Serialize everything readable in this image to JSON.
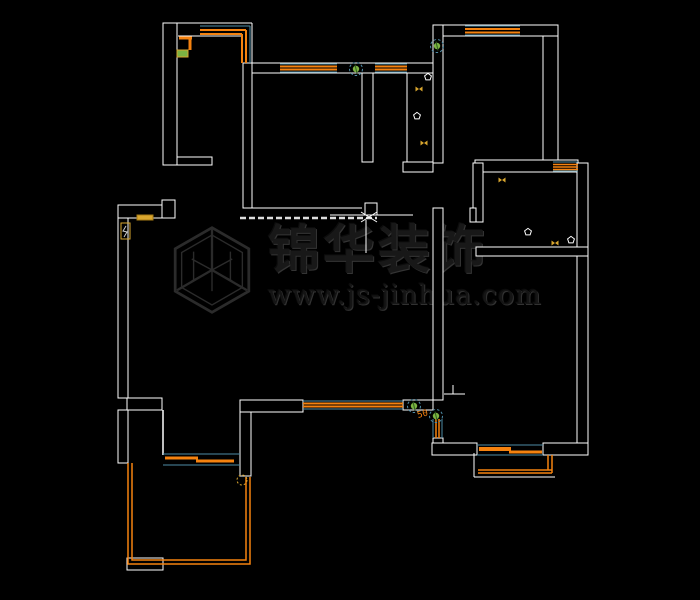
{
  "canvas": {
    "width": 700,
    "height": 600,
    "background": "#000000"
  },
  "watermark": {
    "brand": "锦华装饰",
    "url": "www.js-jinhua.com",
    "logo": "hexagon-cube-icon",
    "color": "#2d2d2d"
  },
  "colors": {
    "wall": "#ffffff",
    "teal": "#4e8ca6",
    "orange": "#f5820f",
    "green": "#7cb342",
    "green_dark": "#2e5d1d",
    "yellow": "#d9a62e",
    "dash_white": "#dddddd",
    "black": "#000000"
  },
  "labels": {
    "dim_50": "50"
  },
  "floorplan": {
    "elements": [
      {
        "t": "rect",
        "n": "wall-band",
        "x": 163,
        "y": 23,
        "w": 14,
        "h": 142,
        "s": "wall",
        "f": "black"
      },
      {
        "t": "rect",
        "n": "wall-band",
        "x": 177,
        "y": 157,
        "w": 35,
        "h": 8,
        "s": "wall",
        "f": "black"
      },
      {
        "t": "rect",
        "n": "wall-band",
        "x": 243,
        "y": 63,
        "w": 9,
        "h": 145,
        "s": "wall",
        "f": "black"
      },
      {
        "t": "rect",
        "n": "wall-band",
        "x": 252,
        "y": 63,
        "w": 181,
        "h": 10,
        "s": "wall",
        "f": "black"
      },
      {
        "t": "rect",
        "n": "wall-band",
        "x": 362,
        "y": 73,
        "w": 11,
        "h": 89,
        "s": "wall",
        "f": "black"
      },
      {
        "t": "rect",
        "n": "wall-band",
        "x": 403,
        "y": 162,
        "w": 30,
        "h": 10,
        "s": "wall",
        "f": "black"
      },
      {
        "t": "rect",
        "n": "wall-band",
        "x": 433,
        "y": 25,
        "w": 10,
        "h": 138,
        "s": "wall",
        "f": "black"
      },
      {
        "t": "rect",
        "n": "wall-band",
        "x": 443,
        "y": 25,
        "w": 115,
        "h": 11,
        "s": "wall",
        "f": "black"
      },
      {
        "t": "rect",
        "n": "wall-band",
        "x": 543,
        "y": 36,
        "w": 15,
        "h": 124,
        "s": "wall",
        "f": "black"
      },
      {
        "t": "rect",
        "n": "wall-band",
        "x": 475,
        "y": 160,
        "w": 103,
        "h": 12,
        "s": "wall",
        "f": "black"
      },
      {
        "t": "rect",
        "n": "wall-band",
        "x": 577,
        "y": 163,
        "w": 11,
        "h": 292,
        "s": "wall",
        "f": "black"
      },
      {
        "t": "rect",
        "n": "wall-band",
        "x": 473,
        "y": 163,
        "w": 10,
        "h": 59,
        "s": "wall",
        "f": "black"
      },
      {
        "t": "rect",
        "n": "wall-band",
        "x": 470,
        "y": 208,
        "w": 6,
        "h": 14,
        "s": "wall",
        "f": "black"
      },
      {
        "t": "rect",
        "n": "wall-band",
        "x": 476,
        "y": 247,
        "w": 112,
        "h": 9,
        "s": "wall",
        "f": "black"
      },
      {
        "t": "rect",
        "n": "wall-band",
        "x": 433,
        "y": 208,
        "w": 10,
        "h": 192,
        "s": "wall",
        "f": "black"
      },
      {
        "t": "rect",
        "n": "wall-band",
        "x": 433,
        "y": 438,
        "w": 10,
        "h": 7,
        "s": "wall",
        "f": "black"
      },
      {
        "t": "rect",
        "n": "wall-band",
        "x": 240,
        "y": 400,
        "w": 63,
        "h": 12,
        "s": "wall",
        "f": "black"
      },
      {
        "t": "rect",
        "n": "wall-band",
        "x": 403,
        "y": 400,
        "w": 30,
        "h": 10,
        "s": "wall",
        "f": "black"
      },
      {
        "t": "rect",
        "n": "wall-band",
        "x": 240,
        "y": 412,
        "w": 11,
        "h": 64,
        "s": "wall",
        "f": "black"
      },
      {
        "t": "rect",
        "n": "wall-band",
        "x": 118,
        "y": 205,
        "w": 45,
        "h": 13,
        "s": "wall",
        "f": "black"
      },
      {
        "t": "rect",
        "n": "wall-band",
        "x": 162,
        "y": 200,
        "w": 13,
        "h": 18,
        "s": "wall",
        "f": "black"
      },
      {
        "t": "rect",
        "n": "wall-band",
        "x": 118,
        "y": 218,
        "w": 10,
        "h": 180,
        "s": "wall",
        "f": "black"
      },
      {
        "t": "rect",
        "n": "wall-band",
        "x": 127,
        "y": 398,
        "w": 35,
        "h": 12,
        "s": "wall",
        "f": "black"
      },
      {
        "t": "rect",
        "n": "wall-band",
        "x": 118,
        "y": 410,
        "w": 10,
        "h": 53,
        "s": "wall",
        "f": "black"
      },
      {
        "t": "rect",
        "n": "wall-band",
        "x": 127,
        "y": 558,
        "w": 36,
        "h": 12,
        "s": "wall",
        "f": "black"
      },
      {
        "t": "rect",
        "n": "wall-band",
        "x": 432,
        "y": 443,
        "w": 45,
        "h": 12,
        "s": "wall",
        "f": "black"
      },
      {
        "t": "rect",
        "n": "wall-band",
        "x": 543,
        "y": 443,
        "w": 45,
        "h": 12,
        "s": "wall",
        "f": "black"
      },
      {
        "t": "line",
        "n": "wall-line",
        "x1": 177,
        "y1": 23,
        "x2": 252,
        "y2": 23,
        "s": "wall",
        "w": 1
      },
      {
        "t": "line",
        "n": "wall-line",
        "x1": 178,
        "y1": 36,
        "x2": 243,
        "y2": 36,
        "s": "wall",
        "w": 1
      },
      {
        "t": "line",
        "n": "wall-line",
        "x1": 252,
        "y1": 23,
        "x2": 252,
        "y2": 63,
        "s": "wall",
        "w": 1
      },
      {
        "t": "line",
        "n": "wall-line",
        "x1": 407,
        "y1": 73,
        "x2": 407,
        "y2": 162,
        "s": "wall",
        "w": 1
      },
      {
        "t": "line",
        "n": "wall-line",
        "x1": 163,
        "y1": 410,
        "x2": 163,
        "y2": 455,
        "s": "wall",
        "w": 1.5
      },
      {
        "t": "line",
        "n": "counter-line",
        "x1": 252,
        "y1": 208,
        "x2": 362,
        "y2": 208,
        "s": "wall",
        "w": 1
      },
      {
        "t": "line",
        "n": "counter-line",
        "x1": 330,
        "y1": 215,
        "x2": 413,
        "y2": 215,
        "s": "wall",
        "w": 1
      },
      {
        "t": "line",
        "n": "beam-dashed-line",
        "x1": 240,
        "y1": 218,
        "x2": 377,
        "y2": 218,
        "s": "dash_white",
        "w": 2.5,
        "dash": "6,3"
      },
      {
        "t": "line",
        "n": "counter-edge-line",
        "x1": 366,
        "y1": 220,
        "x2": 366,
        "y2": 253,
        "s": "wall",
        "w": 1
      },
      {
        "t": "line",
        "n": "wall-line",
        "x1": 453,
        "y1": 385,
        "x2": 453,
        "y2": 394,
        "s": "wall",
        "w": 1
      },
      {
        "t": "line",
        "n": "wall-line",
        "x1": 444,
        "y1": 394,
        "x2": 465,
        "y2": 394,
        "s": "wall",
        "w": 1
      },
      {
        "t": "line",
        "n": "balcony-wall-line",
        "x1": 474,
        "y1": 453,
        "x2": 474,
        "y2": 477,
        "s": "wall",
        "w": 1
      },
      {
        "t": "line",
        "n": "balcony-wall-line",
        "x1": 474,
        "y1": 477,
        "x2": 555,
        "y2": 477,
        "s": "wall",
        "w": 1
      },
      {
        "t": "rect",
        "n": "column-box",
        "x": 365,
        "y": 203,
        "w": 12,
        "h": 12,
        "s": "wall",
        "f": "none"
      },
      {
        "t": "line",
        "n": "cross-mark",
        "x1": 361,
        "y1": 212,
        "x2": 377,
        "y2": 222,
        "s": "wall",
        "w": 1
      },
      {
        "t": "line",
        "n": "cross-mark",
        "x1": 361,
        "y1": 222,
        "x2": 377,
        "y2": 212,
        "s": "wall",
        "w": 1
      },
      {
        "t": "line",
        "n": "bay-window-frame",
        "x1": 200,
        "y1": 26,
        "x2": 250,
        "y2": 26,
        "s": "teal",
        "w": 1
      },
      {
        "t": "line",
        "n": "bay-window-frame",
        "x1": 250,
        "y1": 26,
        "x2": 250,
        "y2": 63,
        "s": "teal",
        "w": 1
      },
      {
        "t": "line",
        "n": "bay-window-pane",
        "x1": 200,
        "y1": 30,
        "x2": 246,
        "y2": 30,
        "s": "orange",
        "w": 2
      },
      {
        "t": "line",
        "n": "bay-window-pane",
        "x1": 246,
        "y1": 30,
        "x2": 246,
        "y2": 63,
        "s": "orange",
        "w": 2
      },
      {
        "t": "line",
        "n": "bay-window-pane",
        "x1": 200,
        "y1": 34,
        "x2": 242,
        "y2": 34,
        "s": "orange",
        "w": 2
      },
      {
        "t": "line",
        "n": "bay-window-pane",
        "x1": 242,
        "y1": 34,
        "x2": 242,
        "y2": 63,
        "s": "orange",
        "w": 2
      },
      {
        "t": "line",
        "n": "window-frame",
        "x1": 465,
        "y1": 26,
        "x2": 520,
        "y2": 26,
        "s": "teal",
        "w": 1
      },
      {
        "t": "line",
        "n": "window-frame",
        "x1": 465,
        "y1": 35,
        "x2": 520,
        "y2": 35,
        "s": "teal",
        "w": 1
      },
      {
        "t": "line",
        "n": "window-pane",
        "x1": 465,
        "y1": 29,
        "x2": 520,
        "y2": 29,
        "s": "orange",
        "w": 2
      },
      {
        "t": "line",
        "n": "window-pane",
        "x1": 465,
        "y1": 32.5,
        "x2": 520,
        "y2": 32.5,
        "s": "orange",
        "w": 2
      },
      {
        "t": "line",
        "n": "window-frame",
        "x1": 280,
        "y1": 64,
        "x2": 337,
        "y2": 64,
        "s": "teal",
        "w": 1
      },
      {
        "t": "line",
        "n": "window-frame",
        "x1": 280,
        "y1": 72,
        "x2": 337,
        "y2": 72,
        "s": "teal",
        "w": 1
      },
      {
        "t": "line",
        "n": "window-pane",
        "x1": 280,
        "y1": 66.5,
        "x2": 337,
        "y2": 66.5,
        "s": "orange",
        "w": 2
      },
      {
        "t": "line",
        "n": "window-pane",
        "x1": 280,
        "y1": 69.5,
        "x2": 337,
        "y2": 69.5,
        "s": "orange",
        "w": 2
      },
      {
        "t": "line",
        "n": "window-frame",
        "x1": 375,
        "y1": 64,
        "x2": 407,
        "y2": 64,
        "s": "teal",
        "w": 1
      },
      {
        "t": "line",
        "n": "window-frame",
        "x1": 375,
        "y1": 72,
        "x2": 407,
        "y2": 72,
        "s": "teal",
        "w": 1
      },
      {
        "t": "line",
        "n": "window-pane",
        "x1": 375,
        "y1": 66.5,
        "x2": 407,
        "y2": 66.5,
        "s": "orange",
        "w": 2
      },
      {
        "t": "line",
        "n": "window-pane",
        "x1": 375,
        "y1": 69.5,
        "x2": 407,
        "y2": 69.5,
        "s": "orange",
        "w": 2
      },
      {
        "t": "line",
        "n": "window-frame",
        "x1": 303,
        "y1": 401,
        "x2": 403,
        "y2": 401,
        "s": "teal",
        "w": 1
      },
      {
        "t": "line",
        "n": "window-frame",
        "x1": 303,
        "y1": 409,
        "x2": 403,
        "y2": 409,
        "s": "teal",
        "w": 1
      },
      {
        "t": "line",
        "n": "window-pane",
        "x1": 303,
        "y1": 403.5,
        "x2": 403,
        "y2": 403.5,
        "s": "orange",
        "w": 2
      },
      {
        "t": "line",
        "n": "window-pane",
        "x1": 303,
        "y1": 406.5,
        "x2": 403,
        "y2": 406.5,
        "s": "orange",
        "w": 2
      },
      {
        "t": "line",
        "n": "window-frame",
        "x1": 553,
        "y1": 162,
        "x2": 578,
        "y2": 162,
        "s": "teal",
        "w": 1
      },
      {
        "t": "line",
        "n": "window-frame",
        "x1": 553,
        "y1": 171,
        "x2": 578,
        "y2": 171,
        "s": "teal",
        "w": 1
      },
      {
        "t": "line",
        "n": "window-pane",
        "x1": 553,
        "y1": 164.5,
        "x2": 578,
        "y2": 164.5,
        "s": "orange",
        "w": 1.5
      },
      {
        "t": "line",
        "n": "window-pane",
        "x1": 553,
        "y1": 167,
        "x2": 578,
        "y2": 167,
        "s": "orange",
        "w": 1.5
      },
      {
        "t": "line",
        "n": "window-pane",
        "x1": 553,
        "y1": 169.5,
        "x2": 578,
        "y2": 169.5,
        "s": "orange",
        "w": 1.5
      },
      {
        "t": "line",
        "n": "window-frame",
        "x1": 433,
        "y1": 419,
        "x2": 433,
        "y2": 438,
        "s": "teal",
        "w": 1
      },
      {
        "t": "line",
        "n": "window-frame",
        "x1": 442,
        "y1": 419,
        "x2": 442,
        "y2": 438,
        "s": "teal",
        "w": 1
      },
      {
        "t": "line",
        "n": "window-pane",
        "x1": 436,
        "y1": 419,
        "x2": 436,
        "y2": 438,
        "s": "orange",
        "w": 1.5
      },
      {
        "t": "line",
        "n": "window-pane",
        "x1": 439,
        "y1": 419,
        "x2": 439,
        "y2": 438,
        "s": "orange",
        "w": 1.5
      },
      {
        "t": "line",
        "n": "sliding-door-frame",
        "x1": 163,
        "y1": 454,
        "x2": 240,
        "y2": 454,
        "s": "teal",
        "w": 1
      },
      {
        "t": "line",
        "n": "sliding-door-frame",
        "x1": 163,
        "y1": 465,
        "x2": 240,
        "y2": 465,
        "s": "teal",
        "w": 1
      },
      {
        "t": "line",
        "n": "sliding-door-leaf",
        "x1": 165,
        "y1": 458,
        "x2": 198,
        "y2": 458,
        "s": "orange",
        "w": 3
      },
      {
        "t": "line",
        "n": "sliding-door-leaf",
        "x1": 196,
        "y1": 461,
        "x2": 234,
        "y2": 461,
        "s": "orange",
        "w": 3
      },
      {
        "t": "line",
        "n": "sliding-door-frame",
        "x1": 477,
        "y1": 445,
        "x2": 543,
        "y2": 445,
        "s": "teal",
        "w": 1
      },
      {
        "t": "line",
        "n": "sliding-door-frame",
        "x1": 477,
        "y1": 455,
        "x2": 543,
        "y2": 455,
        "s": "teal",
        "w": 1
      },
      {
        "t": "line",
        "n": "sliding-door-leaf",
        "x1": 479,
        "y1": 449,
        "x2": 511,
        "y2": 449,
        "s": "orange",
        "w": 4
      },
      {
        "t": "line",
        "n": "sliding-door-leaf",
        "x1": 509,
        "y1": 452,
        "x2": 542,
        "y2": 452,
        "s": "orange",
        "w": 3
      },
      {
        "t": "poly",
        "n": "balcony-railing",
        "p": "128,463 128,564 250,564 250,477",
        "s": "orange",
        "w": 1.5
      },
      {
        "t": "poly",
        "n": "balcony-railing",
        "p": "132,463 132,560 246,560 246,477",
        "s": "orange",
        "w": 1.5
      },
      {
        "t": "line",
        "n": "balcony-railing",
        "x1": 548,
        "y1": 455,
        "x2": 548,
        "y2": 470,
        "s": "orange",
        "w": 1.5
      },
      {
        "t": "line",
        "n": "balcony-railing",
        "x1": 552,
        "y1": 455,
        "x2": 552,
        "y2": 473,
        "s": "orange",
        "w": 1.5
      },
      {
        "t": "line",
        "n": "balcony-railing",
        "x1": 478,
        "y1": 470,
        "x2": 552,
        "y2": 470,
        "s": "orange",
        "w": 1.5
      },
      {
        "t": "line",
        "n": "balcony-railing",
        "x1": 478,
        "y1": 473,
        "x2": 552,
        "y2": 473,
        "s": "orange",
        "w": 1.5
      },
      {
        "t": "line",
        "n": "entry-door-leaf",
        "x1": 179,
        "y1": 38,
        "x2": 192,
        "y2": 38,
        "s": "orange",
        "w": 3
      },
      {
        "t": "line",
        "n": "entry-door-leaf",
        "x1": 190,
        "y1": 38,
        "x2": 190,
        "y2": 50,
        "s": "orange",
        "w": 3
      },
      {
        "t": "rect",
        "n": "entry-door-sill",
        "x": 177,
        "y": 50,
        "w": 11,
        "h": 7,
        "s": "yellow",
        "f": "green"
      },
      {
        "t": "rect",
        "n": "wall-switch-panel",
        "x": 137,
        "y": 215,
        "w": 16,
        "h": 5,
        "s": "#a87b14",
        "f": "yellow"
      },
      {
        "t": "rect",
        "n": "meter-box",
        "x": 121,
        "y": 223,
        "w": 9,
        "h": 16,
        "s": "yellow",
        "f": "none"
      },
      {
        "t": "poly",
        "n": "meter-box-glyph",
        "p": "126,226 123,231 127,232 124,237",
        "s": "#cccccc",
        "w": 1
      },
      {
        "t": "circle",
        "n": "door-knob-circle",
        "x": 242,
        "y": 480,
        "r": 5,
        "s": "yellow",
        "dash": "2,2"
      },
      {
        "t": "door",
        "n": "swing-door",
        "x": 356,
        "y": 69
      },
      {
        "t": "door",
        "n": "swing-door",
        "x": 437,
        "y": 46
      },
      {
        "t": "door",
        "n": "swing-door",
        "x": 414,
        "y": 406
      },
      {
        "t": "door",
        "n": "swing-door",
        "x": 436,
        "y": 416
      },
      {
        "t": "fx",
        "n": "fixture",
        "x": 428,
        "y": 77,
        "k": "w"
      },
      {
        "t": "fx",
        "n": "fixture",
        "x": 419,
        "y": 89,
        "k": "y"
      },
      {
        "t": "fx",
        "n": "fixture",
        "x": 417,
        "y": 116,
        "k": "w"
      },
      {
        "t": "fx",
        "n": "fixture",
        "x": 424,
        "y": 143,
        "k": "y"
      },
      {
        "t": "fx",
        "n": "fixture",
        "x": 502,
        "y": 180,
        "k": "y"
      },
      {
        "t": "fx",
        "n": "fixture",
        "x": 528,
        "y": 232,
        "k": "w"
      },
      {
        "t": "fx",
        "n": "fixture",
        "x": 555,
        "y": 243,
        "k": "y"
      },
      {
        "t": "fx",
        "n": "fixture",
        "x": 571,
        "y": 240,
        "k": "w"
      },
      {
        "t": "text",
        "n": "dim-label",
        "x": 418,
        "y": 418,
        "bind": "labels.dim_50",
        "f": "orange",
        "size": 9,
        "rot": -15
      }
    ]
  }
}
